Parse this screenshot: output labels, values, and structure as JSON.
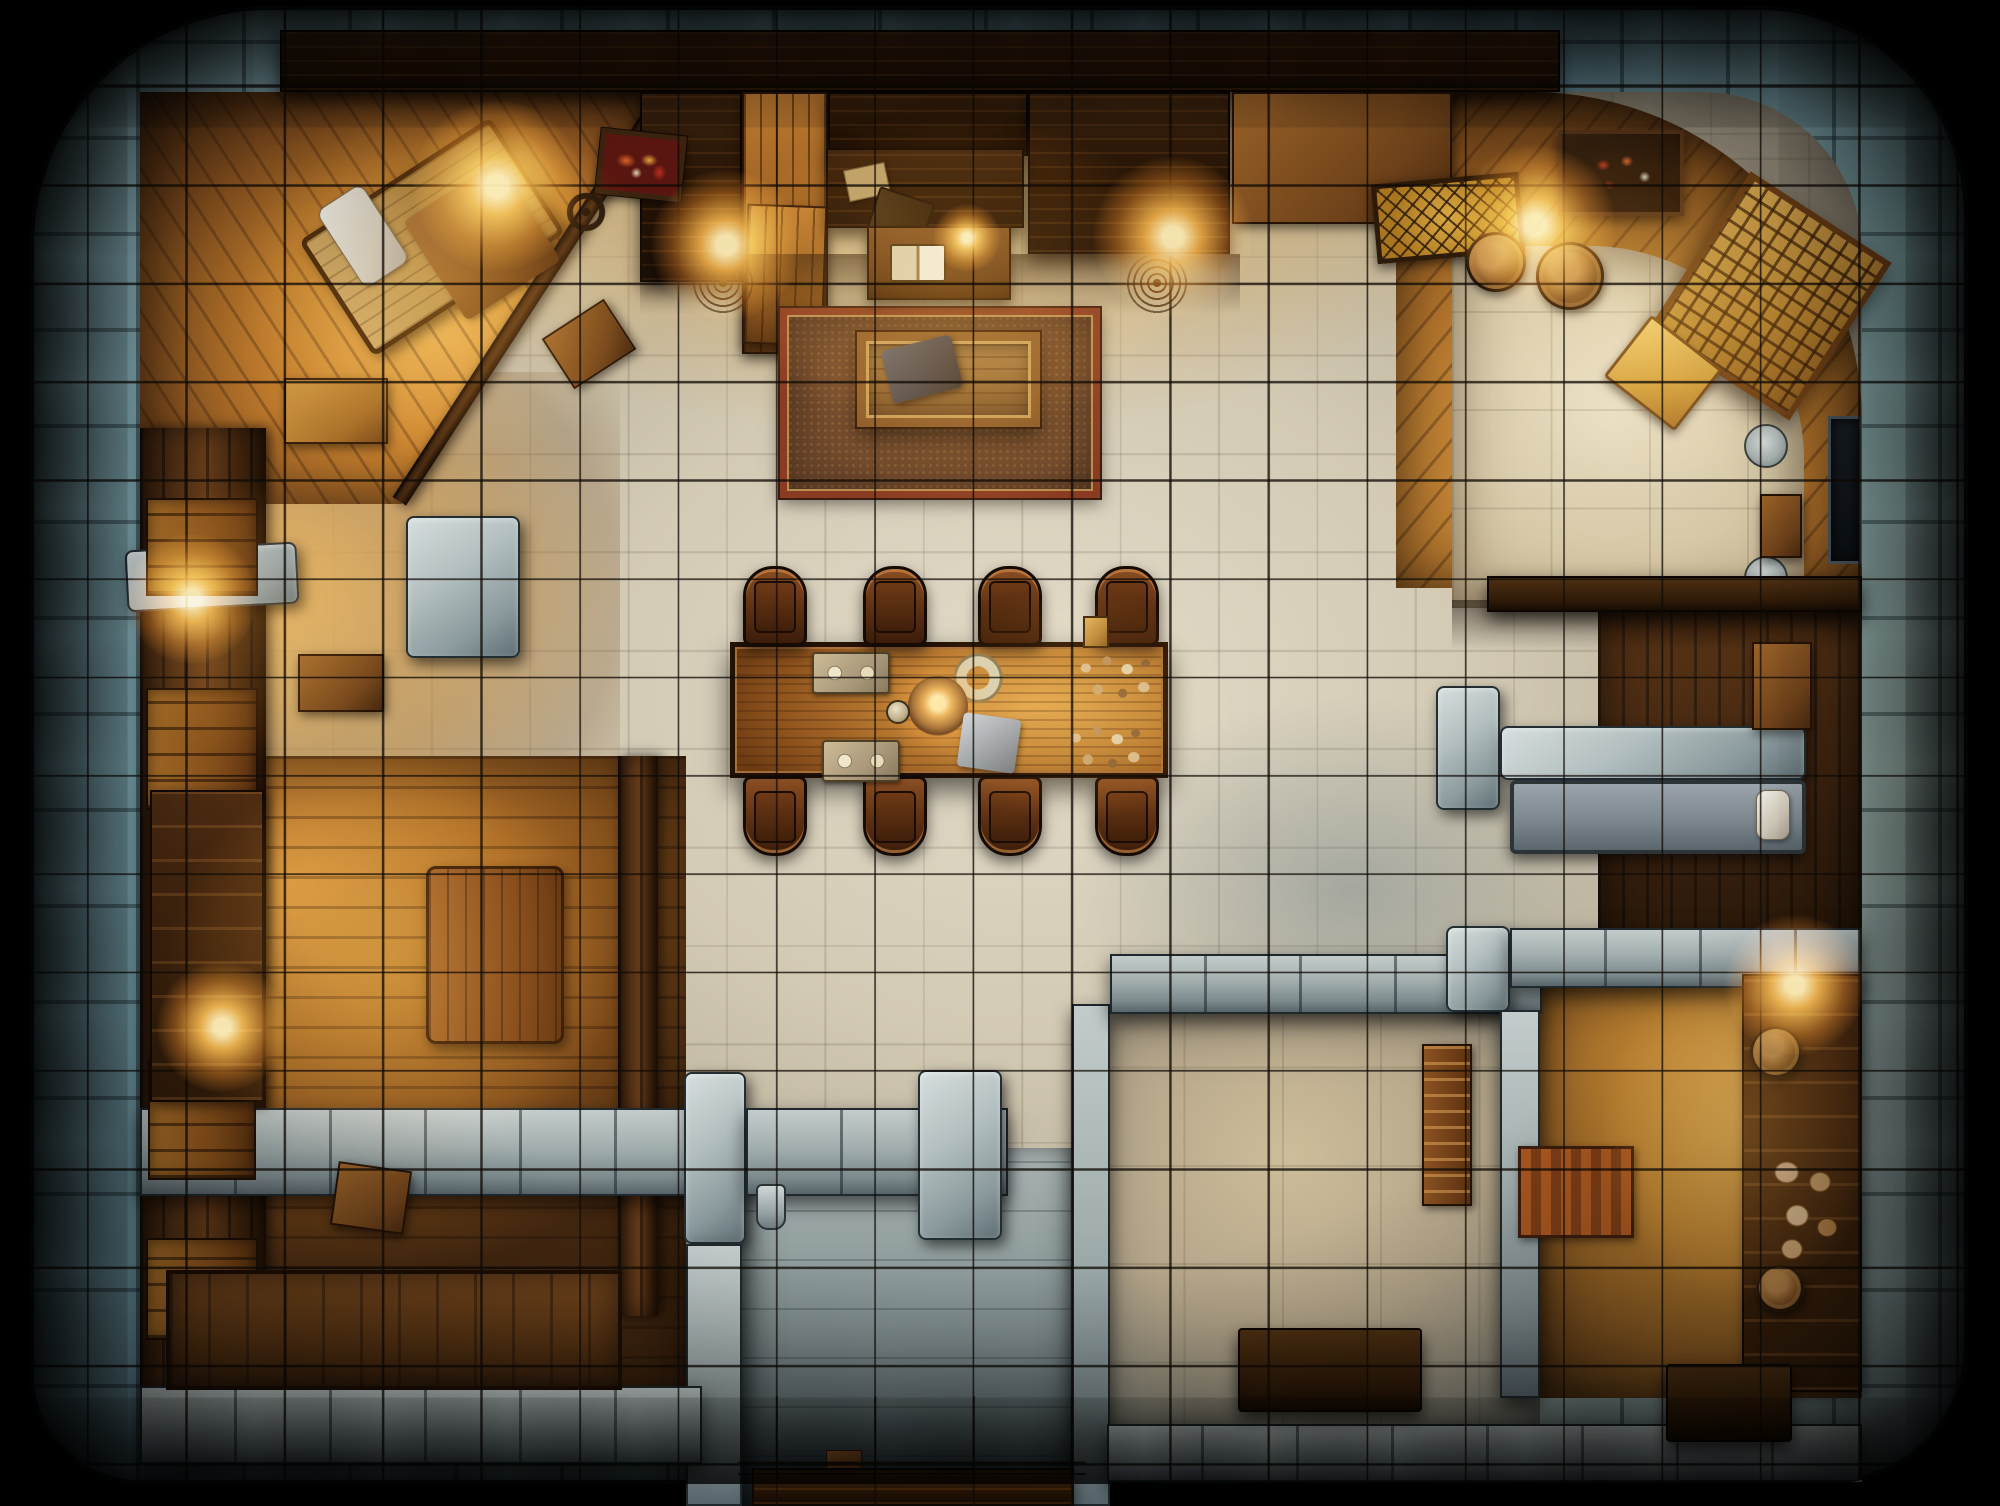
{
  "map": {
    "width": 2000,
    "height": 1506,
    "background": "#000000",
    "grid": {
      "pitch": 98.4,
      "offset_x": 87,
      "offset_y": 86,
      "thickness": 2,
      "line_color": "rgba(16,11,6,0.78)"
    },
    "palette": {
      "outer_stone": "#7aa2ac",
      "hall_tile": "#d3cab4",
      "warm_tile": "#d6b26a",
      "wood_floor": "#b06f28",
      "wood_wall": "#553216",
      "counter": "#241305",
      "stone_block": "#a2aeae",
      "rug_border": "#8a3c22",
      "rug_fill": "#6e482c",
      "table_wood": "#c08236",
      "chair_wood": "#5c3012",
      "glow": "#ffb84d"
    },
    "frame_radius": "240px 210px 140px 110px",
    "elements": [
      [
        "outer-stone-wall",
        "stone-ring",
        30,
        6,
        1938,
        1478,
        {
          "br": "240px 210px 140px 110px"
        }
      ],
      [
        "main-hall-floor",
        "floor-hall",
        140,
        92,
        1722,
        1304,
        {
          "br": "170px 160px 70px 60px"
        }
      ],
      [
        "warm-light-upper",
        "warm-fade",
        330,
        92,
        1200,
        360,
        {}
      ],
      [
        "hall-cool-shade",
        "cool-shade",
        1000,
        640,
        700,
        500,
        {}
      ],
      [
        "left-room-floor",
        "warm-left",
        142,
        372,
        478,
        400,
        {}
      ],
      [
        "bottom-left-room-floor",
        "floor-planks",
        140,
        756,
        546,
        648,
        {}
      ],
      [
        "corner-suite-room",
        "suite-wood",
        140,
        92,
        522,
        412,
        {
          "clip": "polygon(0 0,100% 0,100% 2%,50% 100%,0 100%)"
        }
      ],
      [
        "study-corner-wood",
        "tr-wood",
        1396,
        92,
        466,
        496,
        {
          "br": "0 330px 0 0"
        }
      ],
      [
        "study-floor",
        "floor-bone",
        1452,
        246,
        352,
        362,
        {
          "br": "0 215px 0 0"
        }
      ],
      [
        "right-mid-room-floor",
        "floor-darkwood",
        1598,
        610,
        264,
        388,
        {}
      ],
      [
        "right-lower-room-floor",
        "warm-right",
        1538,
        988,
        324,
        410,
        {}
      ],
      [
        "bottom-right-room-floor",
        "floor-graywarm",
        1085,
        1010,
        455,
        452,
        {}
      ],
      [
        "entry-corridor-floor",
        "corridor",
        738,
        1148,
        348,
        358,
        {}
      ],
      [
        "top-carved-beam",
        "counter-dark",
        280,
        30,
        1280,
        62,
        {}
      ],
      [
        "left-wood-wall",
        "wall-wood-v",
        140,
        428,
        126,
        972,
        {}
      ],
      [
        "suite-partition-wall",
        "wall-wood-v",
        522,
        60,
        16,
        480,
        {
          "rot": 33
        }
      ],
      [
        "bottom-left-partition-wall",
        "wall-wood-v",
        618,
        756,
        40,
        560,
        {}
      ],
      [
        "bar-counter-left",
        "counter-dark",
        640,
        92,
        102,
        190,
        {}
      ],
      [
        "bar-plank-panel",
        "plank-panel",
        742,
        92,
        86,
        262,
        {}
      ],
      [
        "bar-counter-mid",
        "counter-dark",
        828,
        92,
        200,
        64,
        {}
      ],
      [
        "bar-counter-right",
        "counter-dark",
        1028,
        92,
        202,
        162,
        {}
      ],
      [
        "top-cabinet",
        "wood-cab",
        1232,
        92,
        220,
        132,
        {}
      ],
      [
        "hanging-panel",
        "plank-panel",
        745,
        205,
        80,
        140,
        {
          "rot": 2
        }
      ],
      [
        "bar-shadow",
        "soft-shadow",
        640,
        254,
        600,
        60,
        {}
      ],
      [
        "study-shadow",
        "soft-shadow",
        1452,
        600,
        410,
        50,
        {}
      ],
      [
        "left-stone-ledge",
        "stone-slab",
        126,
        546,
        172,
        62,
        {
          "rot": -3
        }
      ],
      [
        "hall-stone-pier",
        "stone-slab",
        406,
        516,
        114,
        142,
        {}
      ],
      [
        "south-wall-band-left",
        "stone-band",
        140,
        1108,
        602,
        88,
        {}
      ],
      [
        "corridor-pier-left",
        "stone-slab",
        684,
        1072,
        62,
        172,
        {}
      ],
      [
        "south-wall-band-mid",
        "stone-band",
        746,
        1108,
        262,
        88,
        {}
      ],
      [
        "corridor-pier-mid",
        "stone-slab",
        918,
        1070,
        84,
        170,
        {}
      ],
      [
        "corridor-column-left",
        "stone-band",
        686,
        1244,
        56,
        262,
        {}
      ],
      [
        "corridor-column-right",
        "stone-band",
        1072,
        1004,
        38,
        502,
        {}
      ],
      [
        "south-wall-band-right",
        "stone-band",
        1110,
        954,
        432,
        60,
        {}
      ],
      [
        "stone-pier-blue",
        "stone-slab",
        1446,
        926,
        64,
        86,
        {}
      ],
      [
        "south-wall-band-far-right",
        "stone-band",
        1510,
        928,
        352,
        60,
        {}
      ],
      [
        "right-stone-pier",
        "stone-slab",
        1436,
        686,
        64,
        124,
        {}
      ],
      [
        "right-stone-ledge",
        "stone-slab",
        1500,
        726,
        306,
        54,
        {}
      ],
      [
        "bottom-wall-slabs-left",
        "stone-band",
        140,
        1386,
        562,
        78,
        {}
      ],
      [
        "bottom-wall-slabs-right",
        "stone-band",
        1107,
        1424,
        755,
        58,
        {}
      ],
      [
        "right-lower-wall-strip",
        "stone-band",
        1500,
        1010,
        40,
        388,
        {}
      ],
      [
        "hall-rug",
        "rug",
        780,
        308,
        320,
        190,
        {}
      ],
      [
        "open-casket",
        "casket",
        857,
        332,
        183,
        95,
        {}
      ],
      [
        "casket-cloth",
        "cloth-dark",
        886,
        342,
        72,
        54,
        {
          "rot": -14
        }
      ],
      [
        "writing-desk-dark",
        "counter-dark",
        826,
        148,
        198,
        80,
        {}
      ],
      [
        "desk-paper",
        "paper",
        846,
        166,
        42,
        32,
        {
          "rot": -12
        }
      ],
      [
        "closed-book",
        "book-dark",
        872,
        194,
        58,
        44,
        {
          "rot": 18
        }
      ],
      [
        "side-desk",
        "desk-wood",
        867,
        226,
        144,
        74,
        {}
      ],
      [
        "open-book",
        "book-open",
        890,
        244,
        56,
        38,
        {}
      ],
      [
        "iron-rosette-left",
        "rosette",
        690,
        250,
        66,
        66,
        {}
      ],
      [
        "iron-rosette-right",
        "rosette",
        1124,
        250,
        66,
        66,
        {}
      ],
      [
        "stained-painting-red",
        "painting-red",
        598,
        132,
        86,
        66,
        {
          "rot": 6
        }
      ],
      [
        "stained-painting-gold",
        "painting-gold",
        1374,
        178,
        148,
        80,
        {
          "rot": -5
        }
      ],
      [
        "dining-table",
        "table",
        730,
        642,
        438,
        136,
        {}
      ],
      [
        "chair",
        "chair chair-up",
        743,
        566,
        64,
        80,
        {}
      ],
      [
        "chair",
        "chair chair-up",
        863,
        566,
        64,
        80,
        {}
      ],
      [
        "chair",
        "chair chair-up",
        978,
        566,
        64,
        80,
        {}
      ],
      [
        "chair",
        "chair chair-up",
        1095,
        566,
        64,
        80,
        {}
      ],
      [
        "chair",
        "chair chair-dn",
        743,
        776,
        64,
        80,
        {}
      ],
      [
        "chair",
        "chair chair-dn",
        863,
        776,
        64,
        80,
        {}
      ],
      [
        "chair",
        "chair chair-dn",
        978,
        776,
        64,
        80,
        {}
      ],
      [
        "chair",
        "chair chair-dn",
        1095,
        776,
        64,
        80,
        {}
      ],
      [
        "serving-tray",
        "tray",
        812,
        652,
        78,
        42,
        {}
      ],
      [
        "serving-tray",
        "tray",
        822,
        740,
        78,
        42,
        {}
      ],
      [
        "ring-plate",
        "plate-ring",
        952,
        652,
        52,
        52,
        {}
      ],
      [
        "candle-plate",
        "plate-candle",
        908,
        676,
        60,
        60,
        {}
      ],
      [
        "small-mug",
        "mug",
        886,
        700,
        24,
        24,
        {}
      ],
      [
        "table-cloth",
        "cloth-gray",
        960,
        716,
        58,
        54,
        {
          "rot": 8
        }
      ],
      [
        "food-scatter",
        "crumbs",
        1072,
        650,
        92,
        60,
        {}
      ],
      [
        "food-scatter",
        "crumbs",
        1062,
        720,
        92,
        60,
        {}
      ],
      [
        "gold-box",
        "box-gold",
        1083,
        616,
        26,
        32,
        {}
      ],
      [
        "suite-bed",
        "bed-frame",
        318,
        168,
        228,
        138,
        {
          "rot": -33
        }
      ],
      [
        "suite-pillow",
        "pillow",
        336,
        190,
        54,
        92,
        {
          "rot": -33
        }
      ],
      [
        "suite-blanket",
        "blanket",
        426,
        182,
        112,
        118,
        {
          "rot": -33
        }
      ],
      [
        "suite-nightstand",
        "wood-cab",
        552,
        314,
        74,
        60,
        {
          "rot": -33
        }
      ],
      [
        "chandelier-ring",
        "ring-dark",
        556,
        182,
        60,
        60,
        {}
      ],
      [
        "left-cabinet",
        "wood-cab-light",
        284,
        378,
        104,
        66,
        {}
      ],
      [
        "left-chest",
        "wood-cab",
        298,
        654,
        86,
        58,
        {}
      ],
      [
        "wall-shelf",
        "shelf-glow",
        146,
        498,
        112,
        98,
        {}
      ],
      [
        "wall-shelf",
        "shelf-glow",
        146,
        688,
        112,
        122,
        {}
      ],
      [
        "wall-shelf",
        "shelf-glow",
        148,
        1058,
        108,
        122,
        {}
      ],
      [
        "wall-shelf",
        "shelf-glow",
        146,
        1238,
        112,
        102,
        {}
      ],
      [
        "tall-wardrobe",
        "wardrobe",
        150,
        790,
        114,
        312,
        {}
      ],
      [
        "wood-door-slab",
        "door-slab",
        426,
        866,
        138,
        178,
        {}
      ],
      [
        "crate",
        "wood-cab",
        334,
        1166,
        74,
        64,
        {
          "rot": 8
        }
      ],
      [
        "plank-bed",
        "plank-bed",
        166,
        1270,
        456,
        120,
        {}
      ],
      [
        "wall-sconce",
        "sconce",
        756,
        1184,
        30,
        46,
        {}
      ],
      [
        "copper-box",
        "copper",
        826,
        1450,
        36,
        26,
        {}
      ],
      [
        "corridor-threshold",
        "counter-dark",
        752,
        1468,
        322,
        38,
        {}
      ],
      [
        "ladder-rack",
        "rack",
        1422,
        1044,
        50,
        162,
        {}
      ],
      [
        "dark-chest",
        "chest-dark",
        1238,
        1328,
        184,
        84,
        {}
      ],
      [
        "right-cabinet-strip",
        "wardrobe",
        1742,
        974,
        120,
        418,
        {}
      ],
      [
        "food-sacks",
        "sacks",
        1762,
        1146,
        88,
        120,
        {}
      ],
      [
        "barrel",
        "barrel",
        1750,
        1026,
        52,
        52,
        {}
      ],
      [
        "clay-pot",
        "barrel",
        1756,
        1264,
        48,
        48,
        {}
      ],
      [
        "striped-mat",
        "mat-stripe",
        1518,
        1146,
        116,
        92,
        {}
      ],
      [
        "dark-bench",
        "chest-dark",
        1666,
        1364,
        126,
        78,
        {}
      ],
      [
        "gray-bed",
        "bed-gray",
        1510,
        780,
        296,
        74,
        {}
      ],
      [
        "gray-bed-pillow",
        "pillow",
        1756,
        790,
        34,
        50,
        {}
      ],
      [
        "right-dresser",
        "wood-cab",
        1752,
        642,
        60,
        88,
        {}
      ],
      [
        "gray-plate",
        "plate-gray",
        1744,
        556,
        44,
        44,
        {}
      ],
      [
        "dark-wall-panel",
        "panel-dark",
        1828,
        416,
        34,
        148,
        {}
      ],
      [
        "study-bench",
        "bench-dark",
        1487,
        576,
        375,
        36,
        {}
      ],
      [
        "study-barrel",
        "barrel",
        1466,
        232,
        60,
        60,
        {}
      ],
      [
        "study-barrel",
        "barrel",
        1536,
        242,
        68,
        68,
        {}
      ],
      [
        "lattice-wardrobe",
        "lattice",
        1686,
        202,
        168,
        188,
        {
          "rot": 33
        }
      ],
      [
        "gold-floor-mat",
        "gold-mat",
        1618,
        334,
        90,
        78,
        {
          "rot": 38
        }
      ],
      [
        "art-tray",
        "tray-art",
        1558,
        130,
        126,
        86,
        {}
      ],
      [
        "study-chest",
        "wood-cab",
        1760,
        494,
        42,
        64,
        {}
      ],
      [
        "study-plate",
        "plate-gray",
        1744,
        424,
        44,
        44,
        {}
      ],
      [
        "ambient-suite",
        "ambient",
        170,
        50,
        560,
        470,
        {
          "bg": "radial-gradient(closest-side, rgba(255,165,60,0.34), rgba(255,140,40,0.10) 60%, rgba(255,140,40,0) 75%)"
        }
      ],
      [
        "ambient-bar",
        "ambient",
        630,
        60,
        640,
        430,
        {
          "bg": "radial-gradient(closest-side, rgba(255,165,60,0.30), rgba(255,140,40,0.10) 60%, rgba(255,140,40,0) 75%)"
        }
      ],
      [
        "ambient-study",
        "ambient",
        1420,
        70,
        470,
        480,
        {
          "bg": "radial-gradient(closest-side, rgba(255,165,60,0.32), rgba(255,140,40,0.10) 60%, rgba(255,140,40,0) 75%)"
        }
      ],
      [
        "ambient-bottom-left",
        "ambient",
        90,
        690,
        600,
        560,
        {
          "bg": "radial-gradient(closest-side, rgba(255,165,60,0.30), rgba(255,140,40,0.10) 60%, rgba(255,140,40,0) 75%)"
        }
      ],
      [
        "ambient-right-lower",
        "ambient",
        1555,
        910,
        370,
        450,
        {
          "bg": "radial-gradient(closest-side, rgba(255,165,60,0.30), rgba(255,140,40,0.10) 60%, rgba(255,140,40,0) 75%)"
        }
      ],
      [
        "ambient-left-mid",
        "ambient",
        70,
        430,
        380,
        380,
        {
          "bg": "radial-gradient(closest-side, rgba(255,165,60,0.22), rgba(255,140,40,0.08) 60%, rgba(255,140,40,0) 75%)"
        }
      ],
      [
        "ambient-table",
        "ambient",
        860,
        550,
        430,
        310,
        {
          "bg": "radial-gradient(closest-side, rgba(255,165,60,0.20), rgba(255,140,40,0.07) 60%, rgba(255,140,40,0) 75%)"
        }
      ],
      [
        "ambient-rug",
        "ambient",
        750,
        230,
        430,
        330,
        {
          "bg": "radial-gradient(closest-side, rgba(255,165,60,0.16), rgba(255,140,40,0.06) 60%, rgba(255,140,40,0) 75%)"
        }
      ],
      [
        "grid-overlay-main",
        "grid-overlay",
        30,
        6,
        1938,
        1478,
        {
          "br": "240px 210px 140px 110px"
        }
      ],
      [
        "grid-overlay-corridor",
        "grid-overlay",
        738,
        1396,
        348,
        110,
        {}
      ],
      [
        "vignette",
        "vignette",
        30,
        6,
        1938,
        1478,
        {
          "br": "240px 210px 140px 110px"
        }
      ]
    ],
    "lights": [
      {
        "x": 497,
        "y": 186,
        "r": 85
      },
      {
        "x": 726,
        "y": 245,
        "r": 75
      },
      {
        "x": 1173,
        "y": 237,
        "r": 80
      },
      {
        "x": 1535,
        "y": 225,
        "r": 80
      },
      {
        "x": 192,
        "y": 599,
        "r": 65
      },
      {
        "x": 222,
        "y": 1027,
        "r": 65
      },
      {
        "x": 1795,
        "y": 985,
        "r": 70
      },
      {
        "x": 967,
        "y": 238,
        "r": 34
      }
    ]
  }
}
